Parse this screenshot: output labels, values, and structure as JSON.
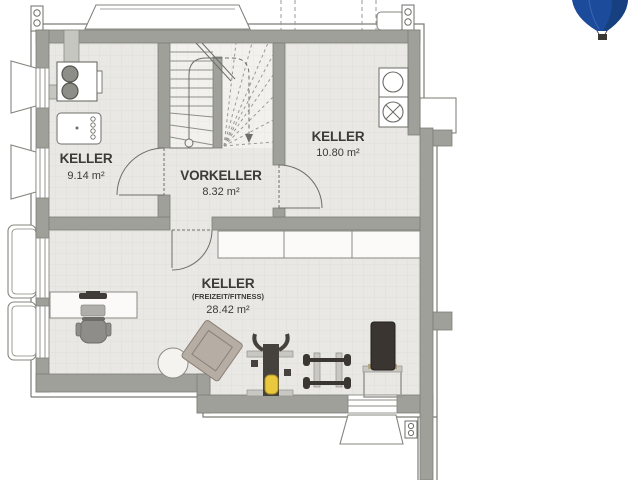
{
  "logo": {
    "name": "hot-air-balloon-logo",
    "color": "#1c4b9c"
  },
  "plan": {
    "rooms": [
      {
        "name": "KELLER",
        "area": "9.14 m²"
      },
      {
        "name": "VORKELLER",
        "area": "8.32 m²"
      },
      {
        "name": "KELLER",
        "area": "10.80 m²"
      },
      {
        "name": "KELLER",
        "subtitle": "(FREIZEIT/FITNESS)",
        "area": "28.42 m²"
      }
    ],
    "fixtures": [
      "heating-boiler",
      "laundry-sink",
      "washing-machine",
      "dryer-crossed-circle",
      "winder-staircase",
      "wall-shelving",
      "desk",
      "office-chair",
      "laptop",
      "ottoman",
      "armchair",
      "weight-bench-barbell",
      "dumbbell-rack",
      "incline-bench",
      "light-well",
      "rain-downpipe"
    ]
  },
  "colors": {
    "wall": "#a0a09a",
    "floor": "#e9e8e4",
    "stair_floor": "#f2f1ee",
    "outline": "#7c7c76",
    "line": "#6e6e69",
    "text": "#3b3b38",
    "logo_blue": "#1c4b9c",
    "seat_yellow": "#e9c83d",
    "equipment_dark": "#3a3733",
    "armchair_tan": "#b6ada5"
  }
}
